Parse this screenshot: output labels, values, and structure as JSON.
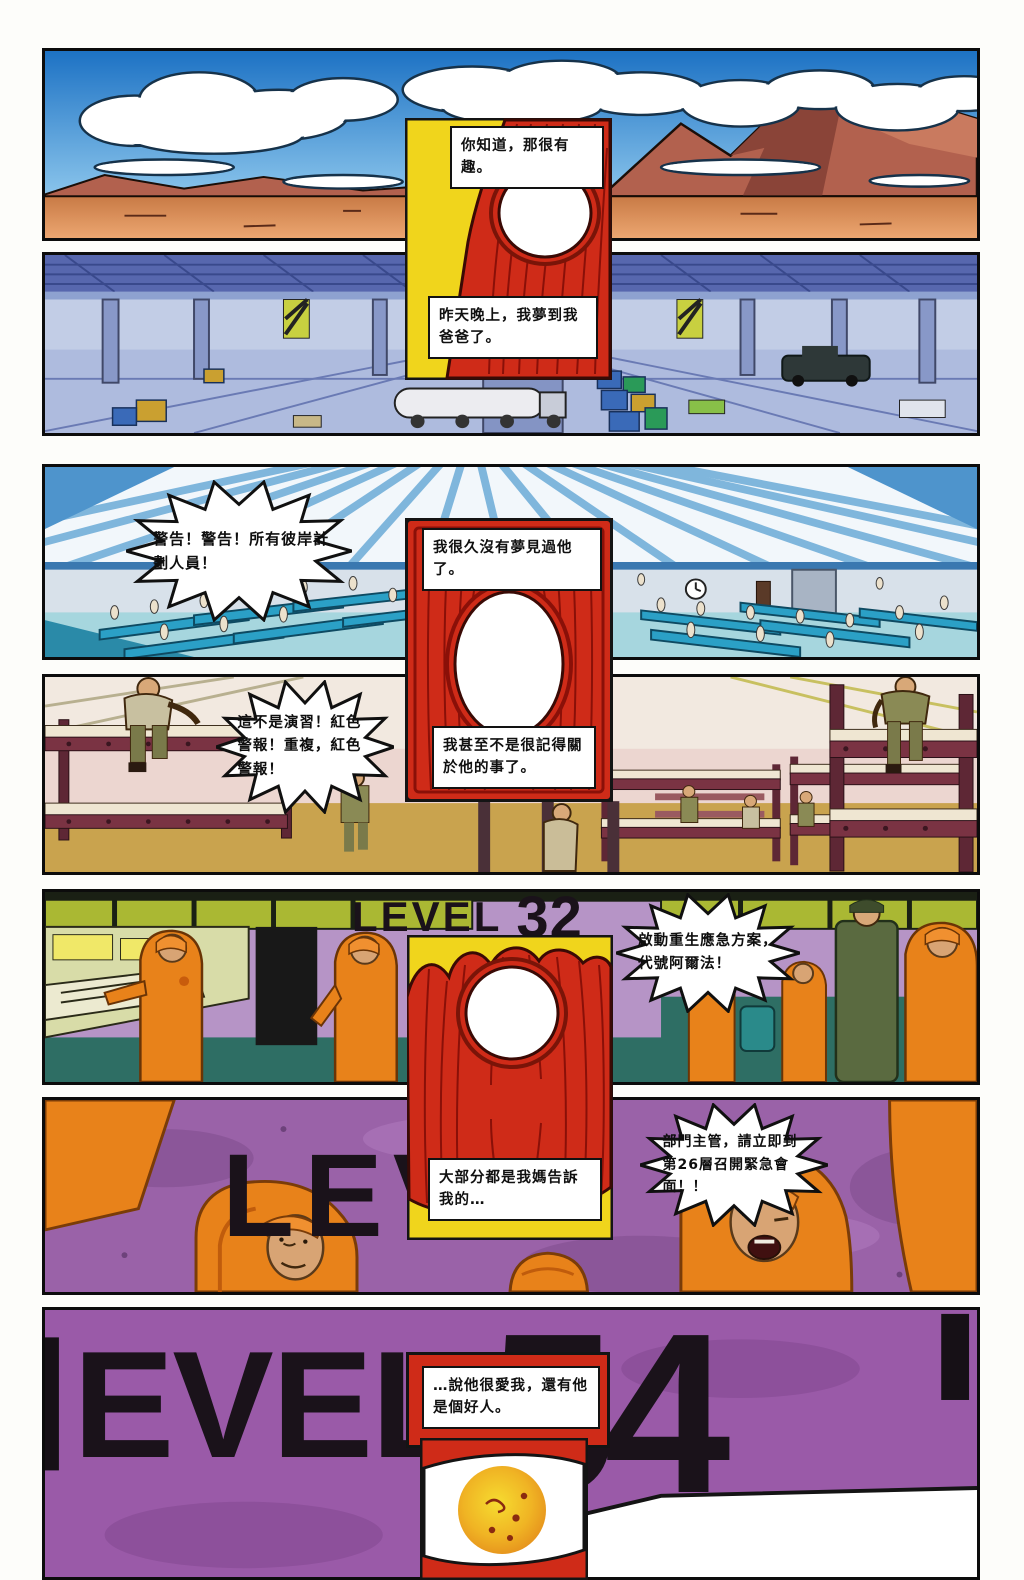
{
  "comic": {
    "signs": {
      "level32_word": "LEVEL",
      "level32_num": "32",
      "lev_partial": "LEV",
      "evel_partial": "EVEL",
      "level54_num": "54"
    },
    "captions": {
      "c1": "你知道，那很有趣。",
      "c2": "昨天晚上，我夢到我爸爸了。",
      "c3": "我很久沒有夢見過他了。",
      "c4": "我甚至不是很記得關於他的事了。",
      "c5": "大部分都是我媽告訴我的…",
      "c6": "…說他很愛我，還有他是個好人。"
    },
    "bubbles": {
      "b1": "警告！警告！所有彼岸計劃人員！",
      "b2": "這不是演習！紅色警報！重複，紅色警報！",
      "b3": "啟動重生應急方案，代號阿爾法！",
      "b4": "部門主管，請立即到第26層召開緊急會面！！"
    },
    "colors": {
      "insert_red": "#cf2b18",
      "insert_grain": "#8a1008",
      "insert_yellow": "#f0d51c",
      "purple": "#9a5aa8",
      "lilac": "#b694c6",
      "worker_orange": "#e8821a",
      "teal_band": "#2e6e64",
      "sky_blue": "#2f86cc",
      "bunk_maroon": "#7a3343"
    }
  }
}
